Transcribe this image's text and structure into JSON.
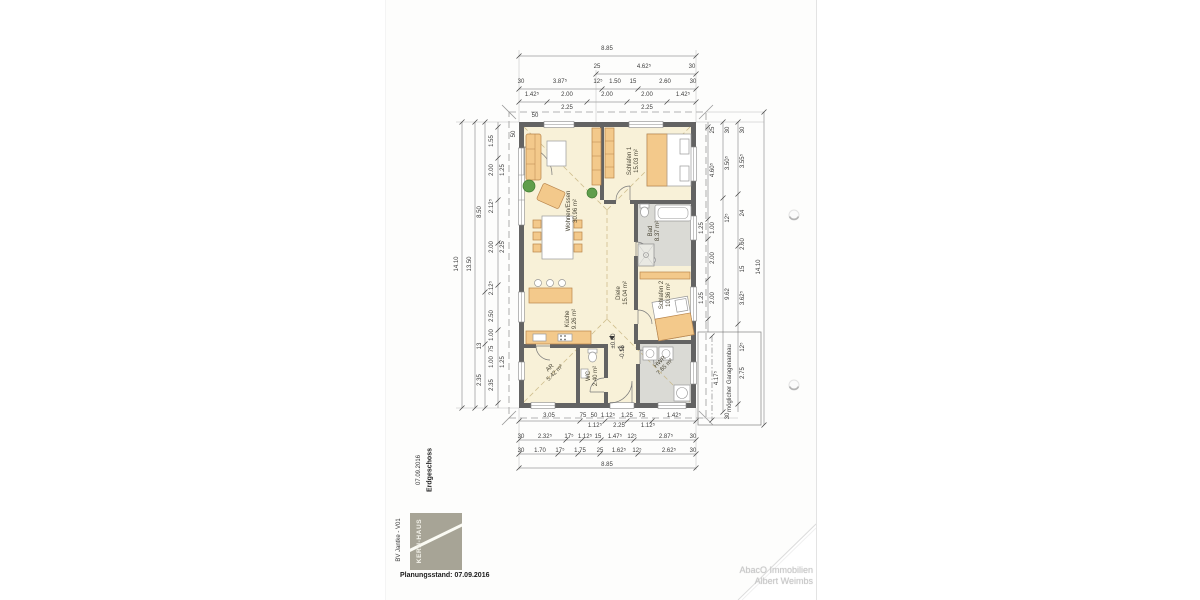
{
  "titleblock": {
    "floor": "Erdgeschoss",
    "date": "07.09.2016",
    "project": "BV Jantke - V01",
    "logo": "KERN-HAUS",
    "status": "Planungsstand: 07.09.2016"
  },
  "watermark": {
    "line1": "AbacO Immobilien",
    "line2": "Albert Weimbs"
  },
  "rooms": {
    "wohnen": {
      "name": "Wohnen/Essen",
      "area": "30.96 m²"
    },
    "schlafen1": {
      "name": "Schlafen 1",
      "area": "15.03 m²"
    },
    "bad": {
      "name": "Bad",
      "area": "8.37 m²"
    },
    "diele": {
      "name": "Diele",
      "area": "15.04 m²"
    },
    "schlafen2": {
      "name": "Schlafen 2",
      "area": "10.36 m²"
    },
    "kueche": {
      "name": "Küche",
      "area": "9.26 m²"
    },
    "ar": {
      "name": "AR",
      "area": "5.42 m²"
    },
    "wc": {
      "name": "WC",
      "area": "2.40 m²"
    },
    "hwr": {
      "name": "HWR",
      "area": "7.65 m²"
    }
  },
  "levels": {
    "ffb": "±0.00",
    "entry": "-0.16"
  },
  "garage": {
    "note": "möglicher Garagenanbau",
    "dim": "4.17⁵"
  },
  "dims": {
    "wall_ticks": [
      "50",
      "50"
    ],
    "top": {
      "overall": "8.85",
      "r3": [
        "25",
        "4.62⁵",
        "30"
      ],
      "r2": [
        "30",
        "3.87⁵",
        "12⁵",
        "1.50",
        "15",
        "2.60",
        "30"
      ],
      "r1": [
        "1.42⁵",
        "2.00",
        "2.00",
        "2.00",
        "1.42⁵"
      ],
      "r1_sub": [
        "2.25",
        "2.25"
      ]
    },
    "bottom": {
      "r1": [
        "3.05",
        "75",
        "50",
        "1.12⁵",
        "1.25",
        "75",
        "1.42⁵"
      ],
      "r1_sub": [
        "1.12⁵",
        "2.25",
        "1.12⁵"
      ],
      "r2": [
        "30",
        "2.32⁵",
        "17⁵",
        "1.12⁵",
        "15",
        "1.47⁵",
        "12⁵",
        "2.87⁵",
        "30"
      ],
      "r3": [
        "30",
        "1.70",
        "17⁵",
        "1.75",
        "25",
        "1.62⁵",
        "12⁵",
        "2.62⁵",
        "30"
      ],
      "overall": "8.85"
    },
    "left": {
      "inner": [
        "1.55",
        "2.00",
        "2.12⁵",
        "2.00",
        "2.12⁵",
        "2.50",
        "1.00",
        "75",
        "1.00",
        "2.35"
      ],
      "inner_sub": [
        "1.25",
        "2.25",
        "1.25"
      ],
      "mid": [
        "8.50",
        "13",
        "2.35"
      ],
      "outer": "13.50",
      "overall": "14.10"
    },
    "right": {
      "inner": [
        "4.60⁵",
        "1.00",
        "2.00",
        "2.00"
      ],
      "inner_sub": [
        "1.25",
        "1.25"
      ],
      "mid": [
        "3.50⁵",
        "12⁵",
        "9.62"
      ],
      "col3": [
        "3.55⁵",
        "24",
        "2.60",
        "15",
        "3.62⁵",
        "12⁵",
        "2.75"
      ],
      "ticks": [
        "25",
        "30",
        "30",
        "30"
      ],
      "overall": "14.10"
    }
  }
}
